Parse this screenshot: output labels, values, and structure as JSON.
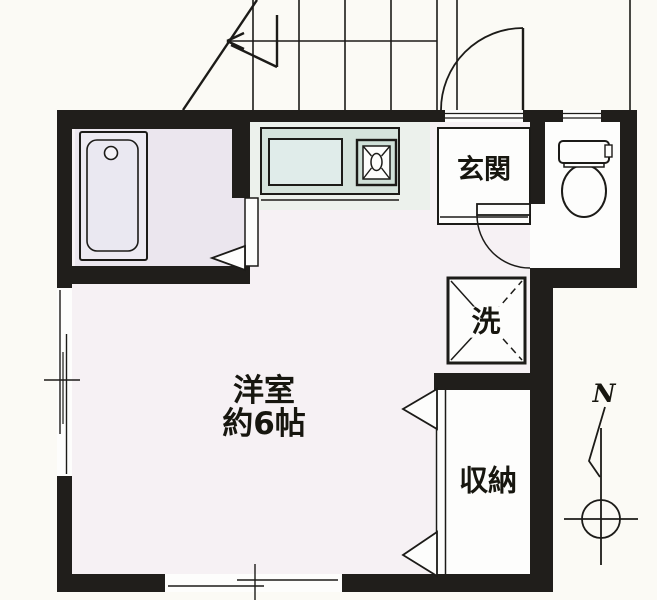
{
  "plan": {
    "rooms": {
      "genkan": {
        "label": "玄関"
      },
      "laundry": {
        "label": "洗"
      },
      "western_room": {
        "name": "洋室",
        "size": "約6帖"
      },
      "closet": {
        "label": "収納"
      }
    },
    "compass": {
      "label": "N"
    },
    "colors": {
      "wall": "#201e1b",
      "line": "#1c1b18",
      "background": "#fbfaf5",
      "main_floor": "#f6f1f4",
      "bathroom_floor": "#ebe6ee",
      "kitchen_tint": "#ecf1ec",
      "counter": "#d5e3dc",
      "sink": "#e0ecea",
      "stove": "#cfe0d8",
      "fixture_fill": "#fdfdfc"
    }
  }
}
